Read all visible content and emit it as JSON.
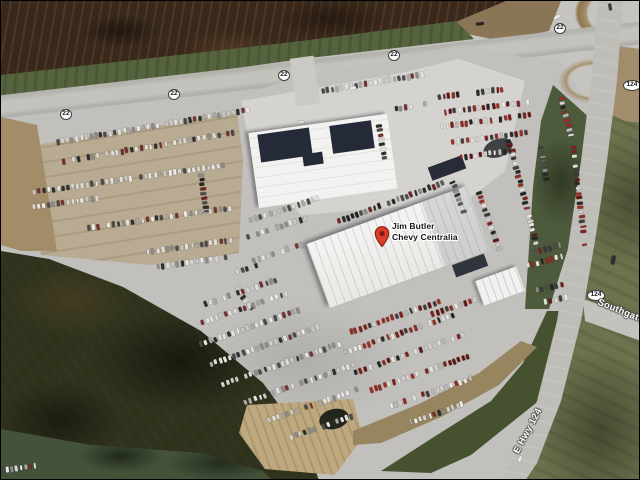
{
  "map": {
    "poi": {
      "line1": "Jim Butler",
      "line2": "Chevy Centralia"
    },
    "route_shields": [
      {
        "x": 65,
        "y": 113,
        "t": "22"
      },
      {
        "x": 173,
        "y": 93,
        "t": "22"
      },
      {
        "x": 283,
        "y": 74,
        "t": "22"
      },
      {
        "x": 393,
        "y": 54,
        "t": "22"
      },
      {
        "x": 559,
        "y": 27,
        "t": "22"
      },
      {
        "x": 631,
        "y": 84,
        "t": "124"
      },
      {
        "x": 595,
        "y": 294,
        "t": "124"
      }
    ],
    "road_labels": [
      {
        "text": "E Hwy 124",
        "x": 527,
        "y": 430,
        "rot": -62,
        "anchor": "center"
      },
      {
        "text": "Southgate",
        "x": 597,
        "y": 301,
        "rot": 22,
        "anchor": "left"
      }
    ],
    "colors": {
      "field_dark": "#38291c",
      "grass_strip": "#55643e",
      "grass_right": "#6d734e",
      "grass_dark": "#4d5a3b",
      "scrub": "#2f331d",
      "dirt_tan": "#a38c68",
      "dirt_light": "#bda87f",
      "road": "#c4c2bd",
      "highway": "#bfbdb8",
      "apron": "#c1c0bd",
      "apron_bright": "#d4d3d0",
      "lot_tan": "#b9a98d",
      "building_white": "#f2f2f0",
      "roof_navy": "#242a38",
      "pin_red": "#dd3b2a",
      "pin_dark": "#7d1d12",
      "label_text": "#151515",
      "halo": "#ffffff",
      "road_label_text": "#ffffff",
      "shield_bg": "#ffffff",
      "shield_border": "#3c3c3c",
      "shield_text": "#1a1a1a"
    },
    "car_palettes": {
      "n": [
        "#eceae6",
        "#e0dfdb",
        "#c8c7c3",
        "#a9a8a4",
        "#8c8b88",
        "#4a4a48",
        "#2e2e2c",
        "#e4e2de",
        "#d5d4d0",
        "#73322c"
      ],
      "c": [
        "#e8e6e2",
        "#d2d0cc",
        "#9c2f27",
        "#7c221d",
        "#5f1915",
        "#3c3c3a",
        "#262624",
        "#b9b8b4",
        "#8e2c25",
        "#e0deda"
      ],
      "d": [
        "#2c2c2a",
        "#3a3a38",
        "#4c4c4a",
        "#232321",
        "#585856",
        "#6e2420",
        "#8a8a86"
      ]
    },
    "car_rows": [
      {
        "x": 57,
        "y": 141,
        "a": -9.5,
        "n": 41,
        "s": 4.8,
        "m": "n"
      },
      {
        "x": 322,
        "y": 90,
        "a": -9.5,
        "n": 23,
        "s": 4.8,
        "m": "n"
      },
      {
        "x": 63,
        "y": 160,
        "a": -9.5,
        "n": 36,
        "s": 4.9,
        "m": "n"
      },
      {
        "x": 33,
        "y": 191,
        "a": -8,
        "n": 40,
        "s": 4.9,
        "m": "n"
      },
      {
        "x": 33,
        "y": 206,
        "a": -8,
        "n": 14,
        "s": 4.9,
        "m": "n"
      },
      {
        "x": 88,
        "y": 227,
        "a": -8,
        "n": 30,
        "s": 4.9,
        "m": "n"
      },
      {
        "x": 147,
        "y": 251,
        "a": -8,
        "n": 18,
        "s": 4.9,
        "m": "n"
      },
      {
        "x": 157,
        "y": 266,
        "a": -8,
        "n": 15,
        "s": 4.9,
        "m": "n"
      },
      {
        "x": 200,
        "y": 174,
        "a": 82,
        "n": 9,
        "s": 4.6,
        "m": "d"
      },
      {
        "x": 378,
        "y": 125,
        "a": 80,
        "n": 8,
        "s": 4.7,
        "m": "n"
      },
      {
        "x": 395,
        "y": 108,
        "a": -9,
        "n": 7,
        "s": 4.9,
        "m": "n"
      },
      {
        "x": 438,
        "y": 96,
        "a": -7,
        "n": 14,
        "s": 4.9,
        "m": "c"
      },
      {
        "x": 444,
        "y": 111,
        "a": -7,
        "n": 18,
        "s": 4.9,
        "m": "c"
      },
      {
        "x": 441,
        "y": 125,
        "a": -7,
        "n": 19,
        "s": 4.9,
        "m": "c"
      },
      {
        "x": 452,
        "y": 141,
        "a": -7,
        "n": 17,
        "s": 4.9,
        "m": "c"
      },
      {
        "x": 460,
        "y": 156,
        "a": -7,
        "n": 12,
        "s": 4.9,
        "m": "c"
      },
      {
        "x": 560,
        "y": 97,
        "a": 75,
        "n": 9,
        "s": 4.7,
        "m": "c"
      },
      {
        "x": 572,
        "y": 146,
        "a": 83,
        "n": 22,
        "s": 4.7,
        "m": "c"
      },
      {
        "x": 540,
        "y": 146,
        "a": 80,
        "n": 9,
        "s": 4.7,
        "m": "d"
      },
      {
        "x": 508,
        "y": 140,
        "a": 75,
        "n": 24,
        "s": 4.6,
        "m": "c"
      },
      {
        "x": 478,
        "y": 192,
        "a": 70,
        "n": 14,
        "s": 4.6,
        "m": "c"
      },
      {
        "x": 452,
        "y": 181,
        "a": 70,
        "n": 8,
        "s": 4.6,
        "m": "d"
      },
      {
        "x": 338,
        "y": 220,
        "a": -20,
        "n": 24,
        "s": 4.8,
        "m": "d"
      },
      {
        "x": 250,
        "y": 219,
        "a": -18,
        "n": 16,
        "s": 5,
        "m": "n"
      },
      {
        "x": 247,
        "y": 236,
        "a": -18,
        "n": 13,
        "s": 5,
        "m": "n"
      },
      {
        "x": 253,
        "y": 259,
        "a": -18,
        "n": 11,
        "s": 5,
        "m": "n"
      },
      {
        "x": 232,
        "y": 272,
        "a": -18,
        "n": 7,
        "s": 5,
        "m": "n"
      },
      {
        "x": 237,
        "y": 288,
        "a": 55,
        "n": 6,
        "s": 4.8,
        "m": "n"
      },
      {
        "x": 530,
        "y": 252,
        "a": -15,
        "n": 7,
        "s": 5,
        "m": "d"
      },
      {
        "x": 522,
        "y": 266,
        "a": -15,
        "n": 9,
        "s": 5,
        "m": "c"
      },
      {
        "x": 536,
        "y": 289,
        "a": -12,
        "n": 6,
        "s": 5,
        "m": "d"
      },
      {
        "x": 540,
        "y": 302,
        "a": -12,
        "n": 6,
        "s": 5,
        "m": "c"
      },
      {
        "x": 205,
        "y": 303,
        "a": -19,
        "n": 16,
        "s": 4.9,
        "m": "n"
      },
      {
        "x": 197,
        "y": 323,
        "a": -19,
        "n": 20,
        "s": 4.9,
        "m": "n"
      },
      {
        "x": 200,
        "y": 343,
        "a": -19,
        "n": 22,
        "s": 4.9,
        "m": "n"
      },
      {
        "x": 210,
        "y": 363,
        "a": -19,
        "n": 24,
        "s": 4.9,
        "m": "n"
      },
      {
        "x": 222,
        "y": 383,
        "a": -19,
        "n": 26,
        "s": 4.9,
        "m": "n"
      },
      {
        "x": 245,
        "y": 401,
        "a": -19,
        "n": 24,
        "s": 4.9,
        "m": "n"
      },
      {
        "x": 268,
        "y": 419,
        "a": -19,
        "n": 20,
        "s": 4.9,
        "m": "n"
      },
      {
        "x": 290,
        "y": 436,
        "a": -19,
        "n": 14,
        "s": 4.9,
        "m": "n"
      },
      {
        "x": 350,
        "y": 331,
        "a": -19,
        "n": 20,
        "s": 4.9,
        "m": "c"
      },
      {
        "x": 345,
        "y": 351,
        "a": -19,
        "n": 24,
        "s": 4.9,
        "m": "c"
      },
      {
        "x": 355,
        "y": 371,
        "a": -19,
        "n": 24,
        "s": 4.9,
        "m": "c"
      },
      {
        "x": 370,
        "y": 389,
        "a": -19,
        "n": 22,
        "s": 4.9,
        "m": "c"
      },
      {
        "x": 390,
        "y": 405,
        "a": -19,
        "n": 18,
        "s": 4.9,
        "m": "c"
      },
      {
        "x": 410,
        "y": 421,
        "a": -19,
        "n": 12,
        "s": 4.9,
        "m": "n"
      },
      {
        "x": 432,
        "y": 313,
        "a": -19,
        "n": 10,
        "s": 4.9,
        "m": "c"
      },
      {
        "x": 2,
        "y": 469,
        "a": -8,
        "n": 8,
        "s": 4.6,
        "m": "n"
      }
    ],
    "vehicles": [
      {
        "x": 479,
        "y": 23,
        "a": -7,
        "l": 8,
        "w": 3.4,
        "c": "#26262a"
      },
      {
        "x": 556,
        "y": 16,
        "a": -30,
        "l": 7,
        "w": 3,
        "c": "#e8e8e6"
      },
      {
        "x": 609,
        "y": 6,
        "a": 80,
        "l": 7,
        "w": 3.2,
        "c": "#3a3a3e"
      },
      {
        "x": 612,
        "y": 259,
        "a": -80,
        "l": 9,
        "w": 3.6,
        "c": "#2e3134"
      },
      {
        "x": 519,
        "y": 458,
        "a": -65,
        "l": 6,
        "w": 3,
        "c": "#e9e9e7"
      },
      {
        "x": 352,
        "y": 87,
        "a": -9,
        "l": 6,
        "w": 3,
        "c": "#ececea"
      },
      {
        "x": 300,
        "y": 121,
        "a": -9,
        "l": 6,
        "w": 3,
        "c": "#d8d8d5"
      }
    ]
  }
}
